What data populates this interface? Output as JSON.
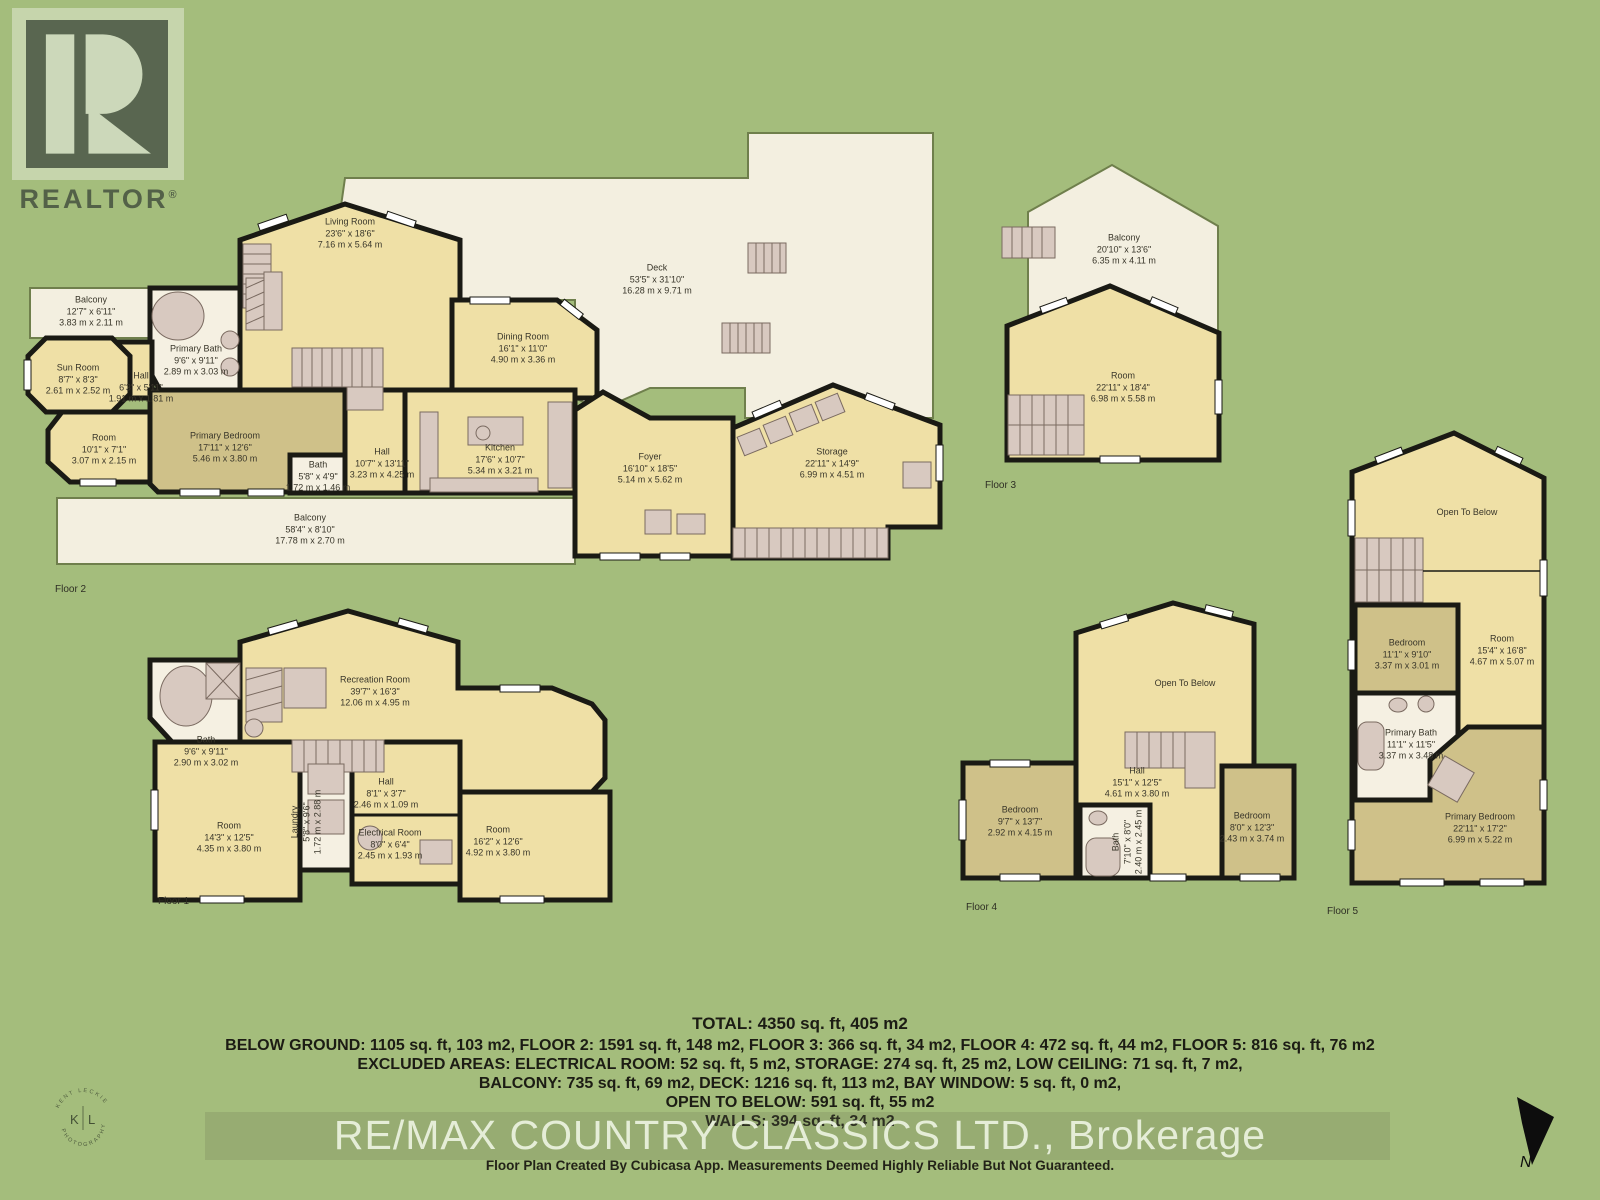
{
  "colors": {
    "background": "#a4bd7c",
    "deck_fill": "#f3efe0",
    "room_fill": "#efe0a6",
    "bedroom_fill": "#cfc189",
    "bath_fill": "#f5f0e2",
    "wall": "#1a1a14",
    "fixture": "#d8c9c0"
  },
  "realtor_logo": {
    "text": "REALTOR",
    "reg": "®"
  },
  "kl_logo": {
    "left": "K",
    "right": "L",
    "arc_top": "KENT LECKIE",
    "arc_bottom": "PHOTOGRAPHY"
  },
  "north": {
    "label": "N"
  },
  "floor2": {
    "label": "Floor 2",
    "rooms": {
      "balcony_top": {
        "name": "Balcony",
        "imp": "12'7\" x 6'11\"",
        "met": "3.83 m x 2.11 m"
      },
      "sun_room": {
        "name": "Sun Room",
        "imp": "8'7\" x 8'3\"",
        "met": "2.61 m x 2.52 m"
      },
      "hall_small": {
        "name": "Hall",
        "imp": "6'3\" x 5'11\"",
        "met": "1.91 m x 1.81 m"
      },
      "primary_bath": {
        "name": "Primary Bath",
        "imp": "9'6\" x 9'11\"",
        "met": "2.89 m x 3.03 m"
      },
      "room_left": {
        "name": "Room",
        "imp": "10'1\" x 7'1\"",
        "met": "3.07 m x 2.15 m"
      },
      "primary_bedroom": {
        "name": "Primary Bedroom",
        "imp": "17'11\" x 12'6\"",
        "met": "5.46 m x 3.80 m"
      },
      "bath": {
        "name": "Bath",
        "imp": "5'8\" x 4'9\"",
        "met": "1.72 m x 1.46 m"
      },
      "hall": {
        "name": "Hall",
        "imp": "10'7\" x 13'11\"",
        "met": "3.23 m x 4.25 m"
      },
      "living_room": {
        "name": "Living Room",
        "imp": "23'6\" x 18'6\"",
        "met": "7.16 m x 5.64 m"
      },
      "dining_room": {
        "name": "Dining Room",
        "imp": "16'1\" x 11'0\"",
        "met": "4.90 m x 3.36 m"
      },
      "kitchen": {
        "name": "Kitchen",
        "imp": "17'6\" x 10'7\"",
        "met": "5.34 m x 3.21 m"
      },
      "deck": {
        "name": "Deck",
        "imp": "53'5\" x 31'10\"",
        "met": "16.28 m x 9.71 m"
      },
      "foyer": {
        "name": "Foyer",
        "imp": "16'10\" x 18'5\"",
        "met": "5.14 m x 5.62 m"
      },
      "storage": {
        "name": "Storage",
        "imp": "22'11\" x 14'9\"",
        "met": "6.99 m x 4.51 m"
      },
      "balcony_bottom": {
        "name": "Balcony",
        "imp": "58'4\" x 8'10\"",
        "met": "17.78 m x 2.70 m"
      }
    }
  },
  "floor3": {
    "label": "Floor 3",
    "rooms": {
      "balcony": {
        "name": "Balcony",
        "imp": "20'10\" x 13'6\"",
        "met": "6.35 m x 4.11 m"
      },
      "room": {
        "name": "Room",
        "imp": "22'11\" x 18'4\"",
        "met": "6.98 m x 5.58 m"
      }
    }
  },
  "floor1": {
    "label": "Floor 1",
    "rooms": {
      "recreation_room": {
        "name": "Recreation Room",
        "imp": "39'7\" x 16'3\"",
        "met": "12.06 m x 4.95 m"
      },
      "bath": {
        "name": "Bath",
        "imp": "9'6\" x 9'11\"",
        "met": "2.90 m x 3.02 m"
      },
      "room_left": {
        "name": "Room",
        "imp": "14'3\" x 12'5\"",
        "met": "4.35 m x 3.80 m"
      },
      "laundry": {
        "name": "Laundry",
        "imp": "5'8\" x 9'6\"",
        "met": "1.72 m x 2.88 m"
      },
      "hall": {
        "name": "Hall",
        "imp": "8'1\" x 3'7\"",
        "met": "2.46 m x 1.09 m"
      },
      "electrical_room": {
        "name": "Electrical Room",
        "imp": "8'0\" x 6'4\"",
        "met": "2.45 m x 1.93 m"
      },
      "room_right": {
        "name": "Room",
        "imp": "16'2\" x 12'6\"",
        "met": "4.92 m x 3.80 m"
      }
    }
  },
  "floor4": {
    "label": "Floor 4",
    "rooms": {
      "open_to_below": {
        "name": "Open To Below"
      },
      "hall": {
        "name": "Hall",
        "imp": "15'1\" x 12'5\"",
        "met": "4.61 m x 3.80 m"
      },
      "bedroom_left": {
        "name": "Bedroom",
        "imp": "9'7\" x 13'7\"",
        "met": "2.92 m x 4.15 m"
      },
      "bath": {
        "name": "Bath",
        "imp": "7'10\" x 8'0\"",
        "met": "2.40 m x 2.45 m"
      },
      "bedroom_right": {
        "name": "Bedroom",
        "imp": "8'0\" x 12'3\"",
        "met": "2.43 m x 3.74 m"
      }
    }
  },
  "floor5": {
    "label": "Floor 5",
    "rooms": {
      "open_to_below": {
        "name": "Open To Below"
      },
      "bedroom": {
        "name": "Bedroom",
        "imp": "11'1\" x 9'10\"",
        "met": "3.37 m x 3.01 m"
      },
      "room": {
        "name": "Room",
        "imp": "15'4\" x 16'8\"",
        "met": "4.67 m x 5.07 m"
      },
      "primary_bath": {
        "name": "Primary Bath",
        "imp": "11'1\" x 11'5\"",
        "met": "3.37 m x 3.48 m"
      },
      "primary_bedroom": {
        "name": "Primary Bedroom",
        "imp": "22'11\" x 17'2\"",
        "met": "6.99 m x 5.22 m"
      }
    }
  },
  "summary": {
    "total": "TOTAL: 4350 sq. ft, 405 m2",
    "areas": "BELOW GROUND: 1105 sq. ft, 103 m2, FLOOR 2: 1591 sq. ft, 148 m2, FLOOR 3: 366 sq. ft, 34 m2, FLOOR 4: 472 sq. ft, 44 m2, FLOOR 5: 816 sq. ft, 76 m2",
    "excluded": "EXCLUDED AREAS: ELECTRICAL ROOM: 52 sq. ft, 5 m2, STORAGE: 274 sq. ft, 25 m2, LOW CEILING: 71 sq. ft, 7 m2,",
    "excluded2": "BALCONY: 735 sq. ft, 69 m2, DECK: 1216 sq. ft, 113 m2, BAY WINDOW: 5 sq. ft, 0 m2,",
    "open_to_below": "OPEN TO BELOW: 591 sq. ft, 55 m2",
    "walls": "WALLS: 394 sq. ft, 34 m2"
  },
  "watermark": "RE/MAX COUNTRY CLASSICS LTD., Brokerage",
  "footer": "Floor Plan Created By Cubicasa App. Measurements Deemed Highly Reliable But Not Guaranteed."
}
